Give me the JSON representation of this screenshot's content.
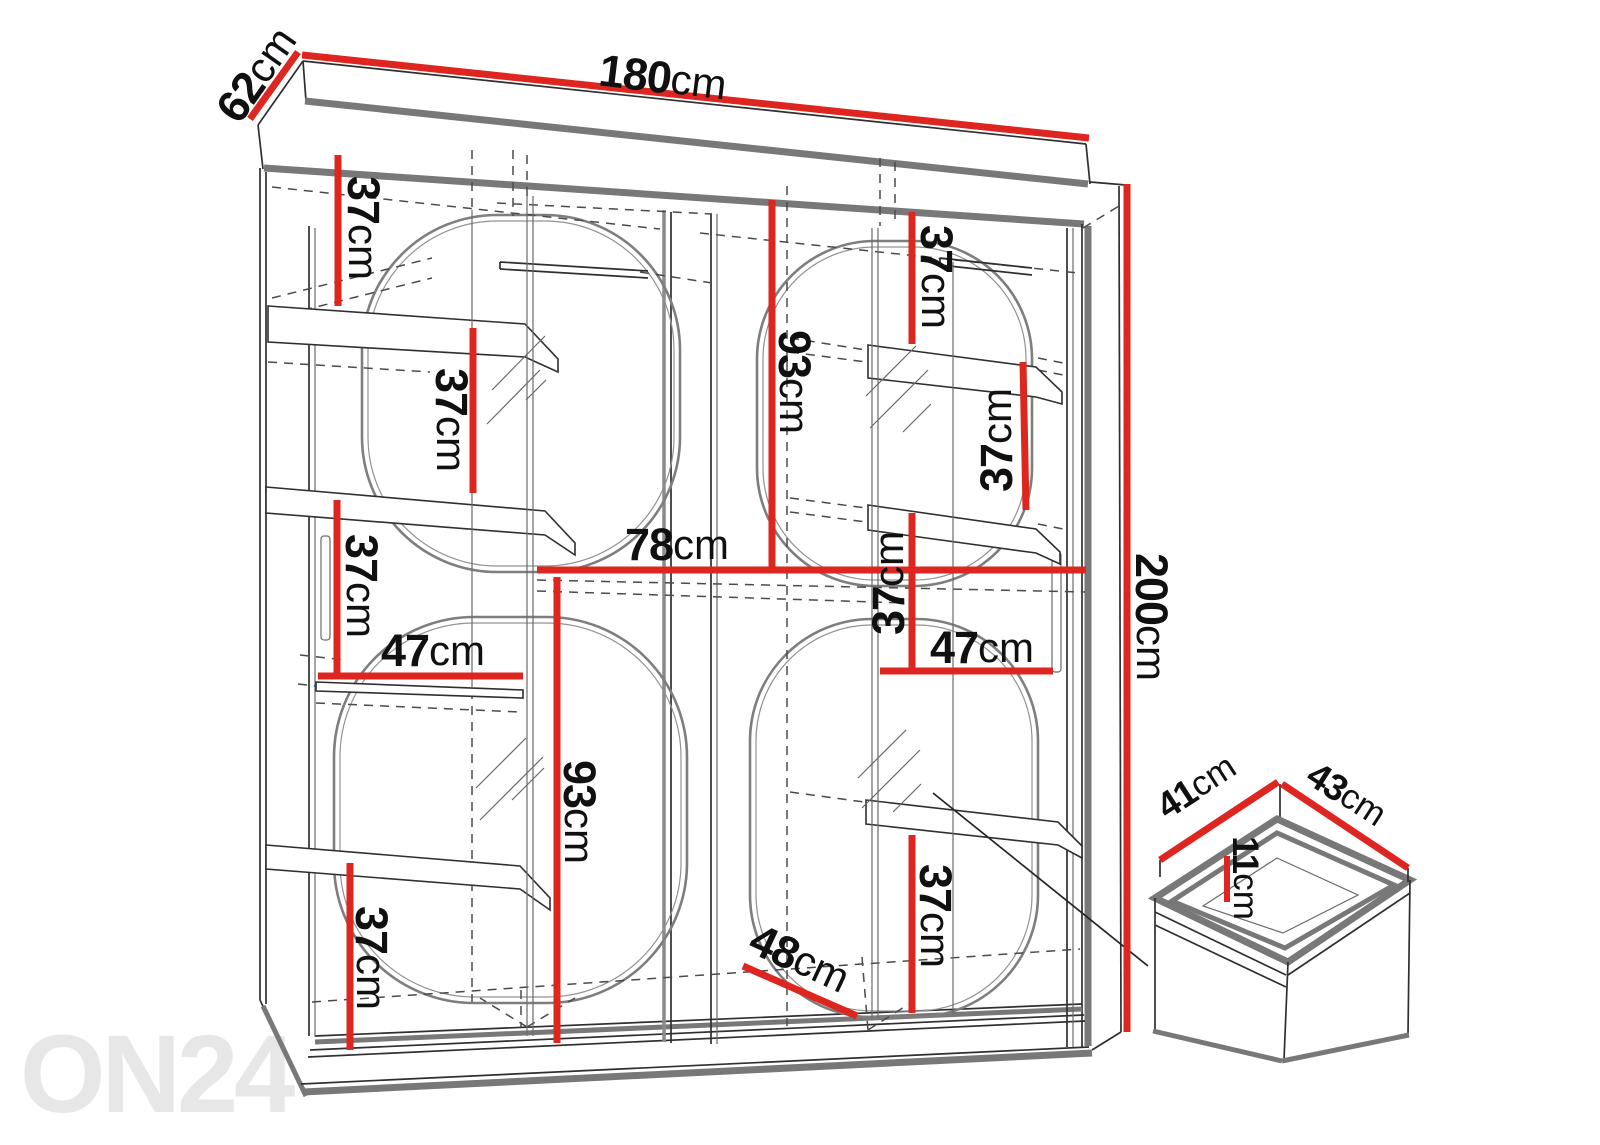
{
  "diagram": {
    "subject": "sliding-door wardrobe dimension drawing",
    "unit": "cm"
  },
  "watermark": {
    "text": "ON24",
    "color": "#e7e7e7"
  },
  "colors": {
    "dimension_line": "#de2620",
    "outline": "#2f2f2f",
    "shade_gray": "#787878",
    "hidden_line": "#4a4a4a",
    "decor_arc": "#7e7e7e",
    "watermark": "#e7e7e7"
  },
  "dims": {
    "width": {
      "value": "180",
      "unit": "cm"
    },
    "depth": {
      "value": "62",
      "unit": "cm"
    },
    "height": {
      "value": "200",
      "unit": "cm"
    },
    "left_top_gap": {
      "value": "37",
      "unit": "cm"
    },
    "left_shelf_gap": {
      "value": "37",
      "unit": "cm"
    },
    "left_mid_gap": {
      "value": "37",
      "unit": "cm"
    },
    "left_shelf_width": {
      "value": "47",
      "unit": "cm"
    },
    "left_hang_height": {
      "value": "93",
      "unit": "cm"
    },
    "left_bottom_gap": {
      "value": "37",
      "unit": "cm"
    },
    "inner_width": {
      "value": "78",
      "unit": "cm"
    },
    "right_top_gap": {
      "value": "37",
      "unit": "cm"
    },
    "right_hang_height": {
      "value": "93",
      "unit": "cm"
    },
    "right_door_gap": {
      "value": "37",
      "unit": "cm"
    },
    "right_mid_gap": {
      "value": "37",
      "unit": "cm"
    },
    "right_shelf_width": {
      "value": "47",
      "unit": "cm"
    },
    "right_bottom_gap": {
      "value": "37",
      "unit": "cm"
    },
    "bottom_depth": {
      "value": "48",
      "unit": "cm"
    },
    "drawer_depth": {
      "value": "41",
      "unit": "cm"
    },
    "drawer_width": {
      "value": "43",
      "unit": "cm"
    },
    "drawer_height": {
      "value": "11",
      "unit": "cm"
    }
  }
}
